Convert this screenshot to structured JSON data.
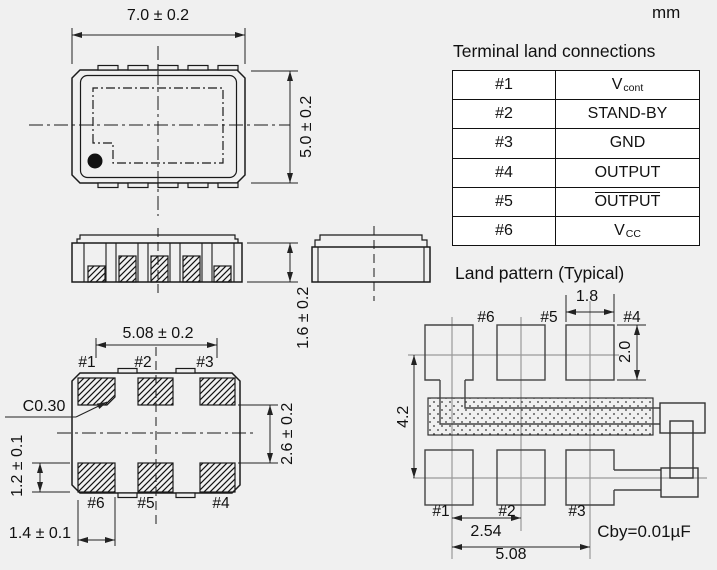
{
  "unit": "mm",
  "colors": {
    "background": "#f0f0f0",
    "line": "#1a1a1a",
    "table_background": "#ffffff"
  },
  "top_view": {
    "width_dim": "7.0 ± 0.2",
    "height_dim": "5.0 ± 0.2"
  },
  "front_view": {
    "thickness_dim": "1.6 ± 0.2"
  },
  "bottom_view": {
    "span_dim": "5.08 ± 0.2",
    "chamfer_label": "C0.30",
    "row_gap_dim": "2.6 ± 0.2",
    "pad_height_dim": "1.2 ± 0.1",
    "pad_width_dim": "1.4 ± 0.1",
    "labels_top": [
      "#1",
      "#2",
      "#3"
    ],
    "labels_bottom": [
      "#6",
      "#5",
      "#4"
    ]
  },
  "terminal_table": {
    "title": "Terminal land connections",
    "rows": [
      {
        "pin": "#1",
        "signal": "V",
        "sub": "cont"
      },
      {
        "pin": "#2",
        "signal": "STAND-BY"
      },
      {
        "pin": "#3",
        "signal": "GND"
      },
      {
        "pin": "#4",
        "signal": "OUTPUT"
      },
      {
        "pin": "#5",
        "signal": "OUTPUT",
        "overline": true
      },
      {
        "pin": "#6",
        "signal": "V",
        "sub": "CC"
      }
    ]
  },
  "land_pattern": {
    "title": "Land pattern (Typical)",
    "labels_top": [
      "#6",
      "#5",
      "#4"
    ],
    "labels_bottom": [
      "#1",
      "#2",
      "#3"
    ],
    "pad_width_dim": "1.8",
    "pad_height_dim": "2.0",
    "row_pitch_dim": "4.2",
    "pitch_dim": "2.54",
    "span_dim": "5.08",
    "bypass_cap_note": "Cby=0.01µF"
  }
}
